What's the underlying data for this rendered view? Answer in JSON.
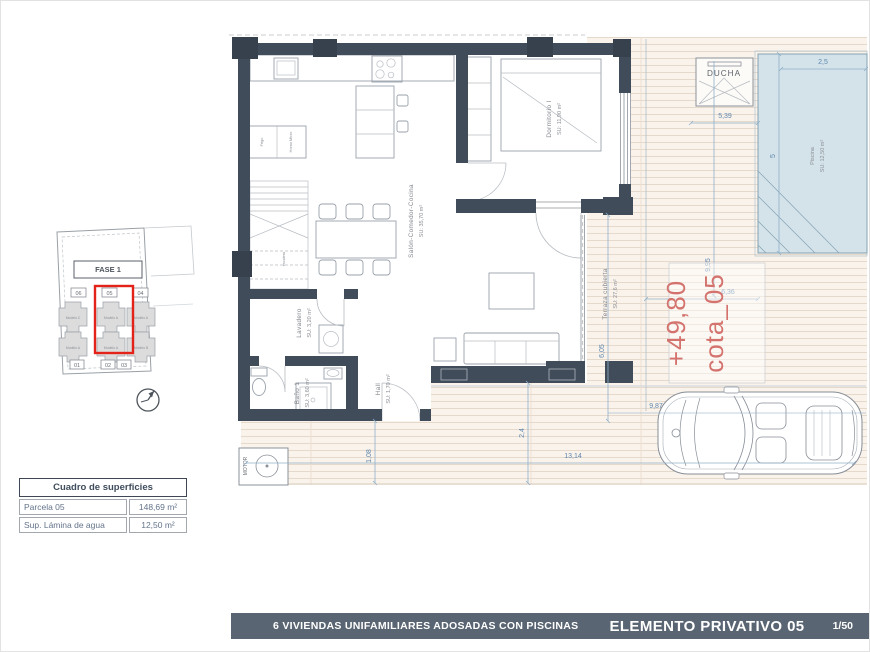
{
  "floor_plan": {
    "rooms": [
      {
        "name": "Salón-Comedor-Cocina",
        "area": "SU: 35,70 m²"
      },
      {
        "name": "Dormitorio I",
        "area": "SU: 11,90 m²"
      },
      {
        "name": "Lavadero",
        "area": "SU: 3,20 m²"
      },
      {
        "name": "Baño 1",
        "area": "SU: 3,60 m²"
      },
      {
        "name": "Hall",
        "area": "SU: 1,70 m²"
      },
      {
        "name": "Terraza cubierta",
        "area": "SU: 27,6 m²"
      },
      {
        "name": "Piscina",
        "area": "SU: 12,50 m²"
      }
    ],
    "labels": {
      "ducha": "DUCHA",
      "motor": "MOTOR",
      "stairs": "escalera",
      "fridge": "Frigo",
      "oven": "Horno Micro"
    },
    "level_mark": {
      "name": "cota_05",
      "value": "+49,80"
    },
    "dimensions": [
      "2,5",
      "5,39",
      "5",
      "9,95",
      "6,36",
      "6,05",
      "9,87",
      "2,4",
      "13,14",
      "1,08"
    ]
  },
  "site_plan": {
    "phase": "FASE 1",
    "highlighted_plot": "05",
    "plots_top": [
      "06",
      "05",
      "04"
    ],
    "plots_bottom": [
      "01",
      "02",
      "03"
    ],
    "models": [
      "Modelo C",
      "Modelo A",
      "Modelo A",
      "Modelo A",
      "Modelo A",
      "Modelo B"
    ]
  },
  "surface_table": {
    "title": "Cuadro de superficies",
    "rows": [
      {
        "label": "Parcela 05",
        "value": "148,69 m²"
      },
      {
        "label": "Sup. Lámina de agua",
        "value": "12,50 m²"
      }
    ]
  },
  "footer": {
    "project": "6 VIVIENDAS UNIFAMILIARES ADOSADAS CON PISCINAS",
    "sheet": "ELEMENTO PRIVATIVO 05",
    "scale": "1/50"
  },
  "colors": {
    "wall": "#414c5b",
    "pool_fill": "#d4e3ea",
    "deck_line": "#e5d9cc",
    "dimension": "#5f87ad",
    "level_mark": "#d4736e",
    "highlight_red": "#e3231a",
    "footer_bg": "#5a6573"
  }
}
